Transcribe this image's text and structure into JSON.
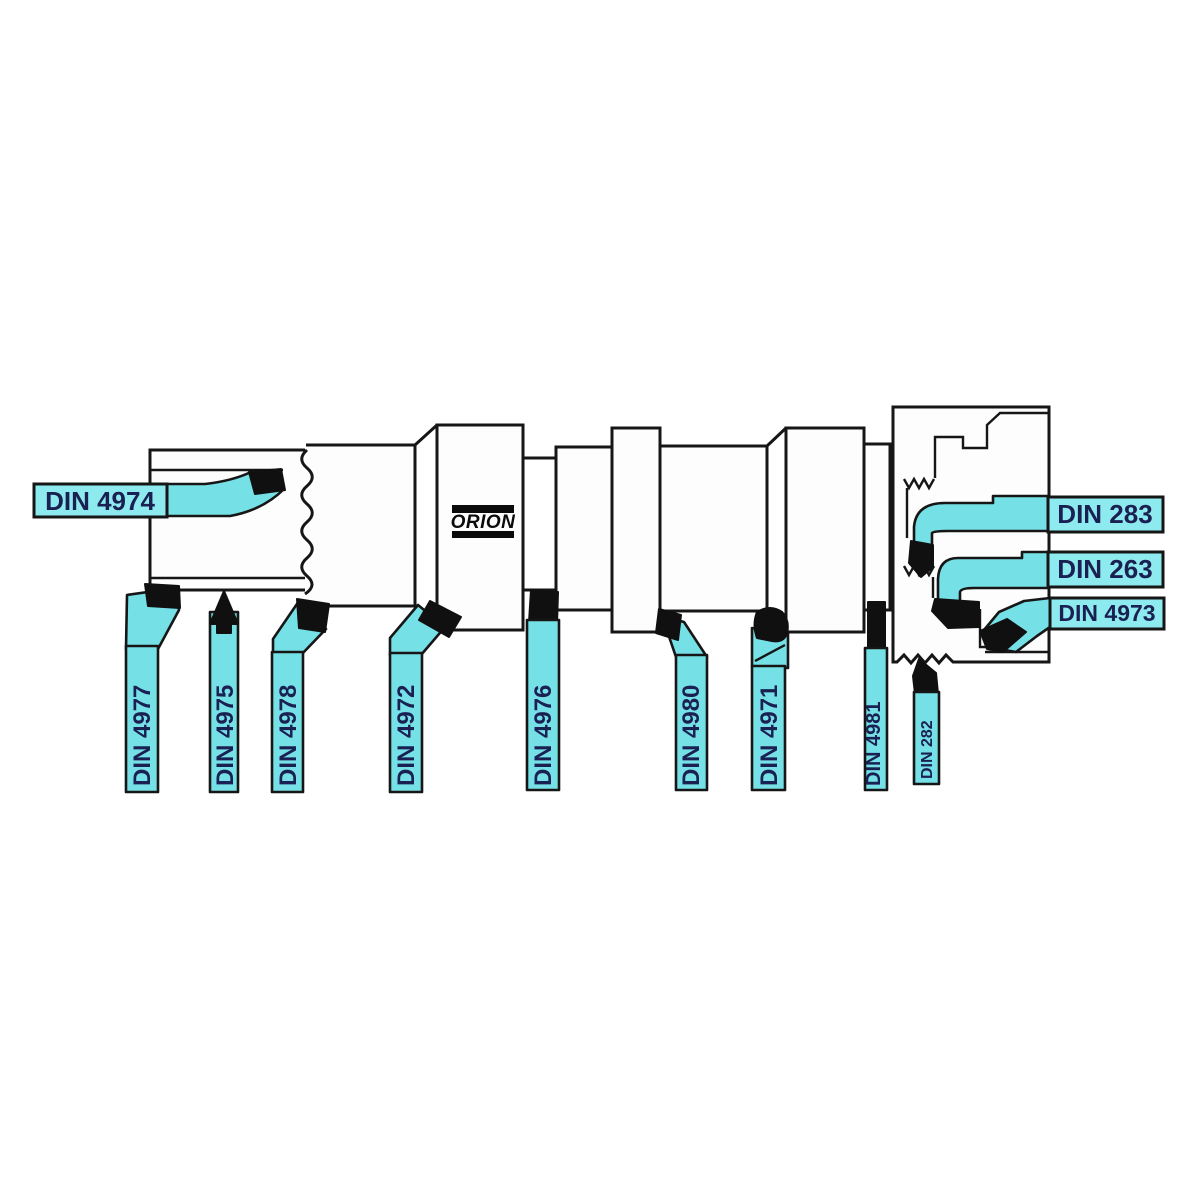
{
  "diagram": {
    "brand": "ORION",
    "description_labels_total": 13,
    "tool_left": {
      "label": "DIN 4974"
    },
    "tools_bottom": [
      {
        "label": "DIN 4977"
      },
      {
        "label": "DIN 4975"
      },
      {
        "label": "DIN 4978"
      },
      {
        "label": "DIN 4972"
      },
      {
        "label": "DIN 4976"
      },
      {
        "label": "DIN 4980"
      },
      {
        "label": "DIN 4971"
      },
      {
        "label": "DIN 4981"
      },
      {
        "label": "DIN 282"
      }
    ],
    "tools_right": [
      {
        "label": "DIN 283"
      },
      {
        "label": "DIN 263"
      },
      {
        "label": "DIN 4973"
      }
    ],
    "colors": {
      "tool_fill": "#76e0e7",
      "label_fill": "#8deaee",
      "outline": "#161616",
      "tip_fill": "#101010",
      "label_text": "#1a2152"
    }
  }
}
